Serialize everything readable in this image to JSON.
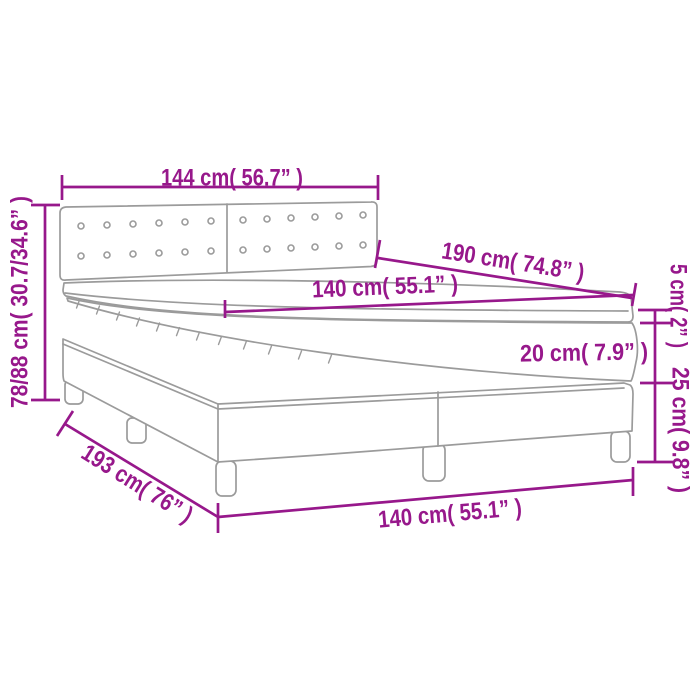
{
  "diagram": {
    "type": "product-dimension-diagram",
    "subject": "box spring bed with tufted headboard, mattress and topper",
    "colors": {
      "dimension_accent": "#97188B",
      "drawing_outline": "#9b9b9b",
      "background": "#ffffff"
    },
    "labels": {
      "headboard_width": "144 cm( 56.7” )",
      "headboard_height": "78/88 cm( 30.7/34.6” )",
      "bed_length": "190 cm( 74.8” )",
      "mattress_width_top": "140 cm( 55.1” )",
      "topper_height": "5 cm( 2” )",
      "mattress_height": "20 cm( 7.9” )",
      "base_height": "25 cm( 9.8” )",
      "total_length": "193 cm( 76” )",
      "bed_width_bottom": "140 cm( 55.1” )"
    }
  }
}
